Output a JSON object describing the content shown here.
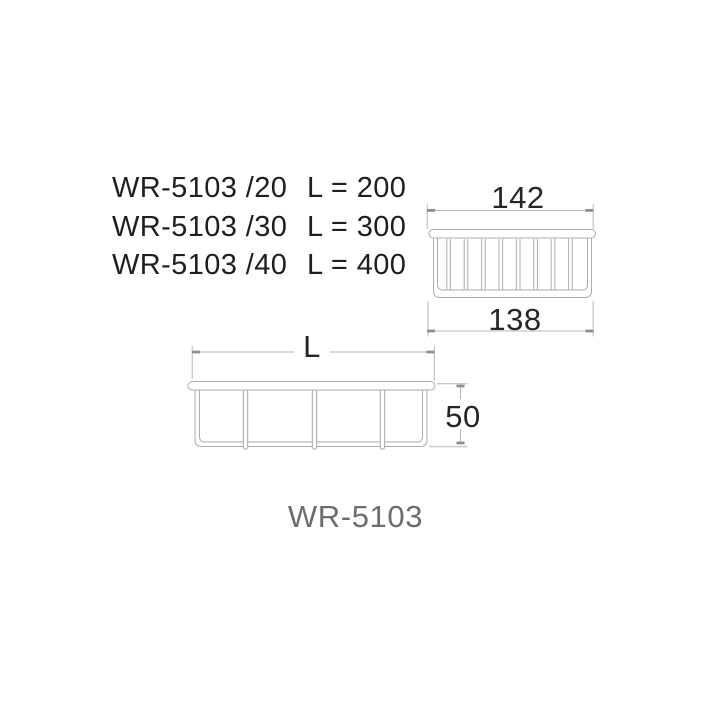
{
  "spec_table": {
    "rows": [
      {
        "model": "WR-5103 /20",
        "length": "L = 200"
      },
      {
        "model": "WR-5103 /30",
        "length": "L = 300"
      },
      {
        "model": "WR-5103 /40",
        "length": "L = 400"
      }
    ]
  },
  "end_view": {
    "dim_top": "142",
    "dim_bottom": "138",
    "wire_count": 8
  },
  "front_view": {
    "dim_length": "L",
    "dim_height": "50",
    "wire_count": 3
  },
  "product_label": "WR-5103",
  "colors": {
    "line": "#abadaf",
    "dim_line": "#b5b7b9",
    "tick": "#8d8f91",
    "text": "#1f1f1f",
    "label_gray": "#6b6e70"
  }
}
